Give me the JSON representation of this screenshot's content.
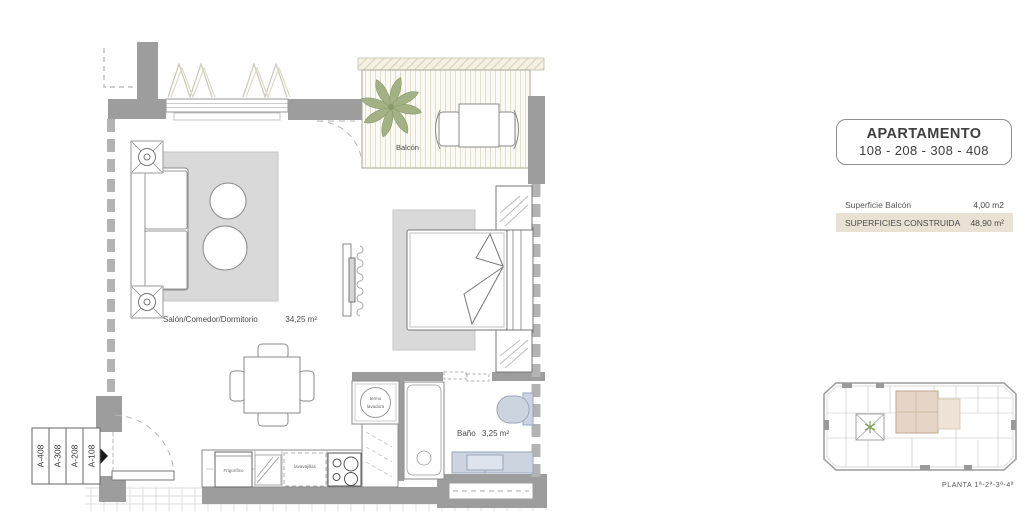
{
  "info_panel": {
    "apartment_box": {
      "title": "APARTAMENTO",
      "units": "108 - 208 - 308 - 408"
    },
    "surface_rows": [
      {
        "label": "Superficie Balcón",
        "value": "4,00 m2"
      },
      {
        "label": "SUPERFICIES CONSTRUIDA",
        "value": "48,90 m²"
      }
    ],
    "keyplan_caption": "PLANTA  1ª-2ª-3ª-4ª"
  },
  "floor_plan": {
    "living_label": "Salón/Comedor/Dormitorio",
    "living_area": "34,25 m²",
    "balcony_label": "Balcón",
    "bath_label": "Baño",
    "bath_area": "3,25 m²",
    "fridge_label": "Frigorífico",
    "dishwasher_label": "lavavajillas",
    "washer_label_line1": "termo",
    "washer_label_line2": "lavadora",
    "entrance_tags": [
      "A-408",
      "A-308",
      "A-208",
      "A-108"
    ]
  },
  "colors": {
    "wall_gray": "#9d9d9d",
    "rug_gray": "#d9d9d9",
    "fixture_blue": "#ccd4e0",
    "highlight_beige": "#e9e2d4",
    "keyplan_highlight": "#e4d5c6",
    "plant_green": "#9cab80"
  }
}
